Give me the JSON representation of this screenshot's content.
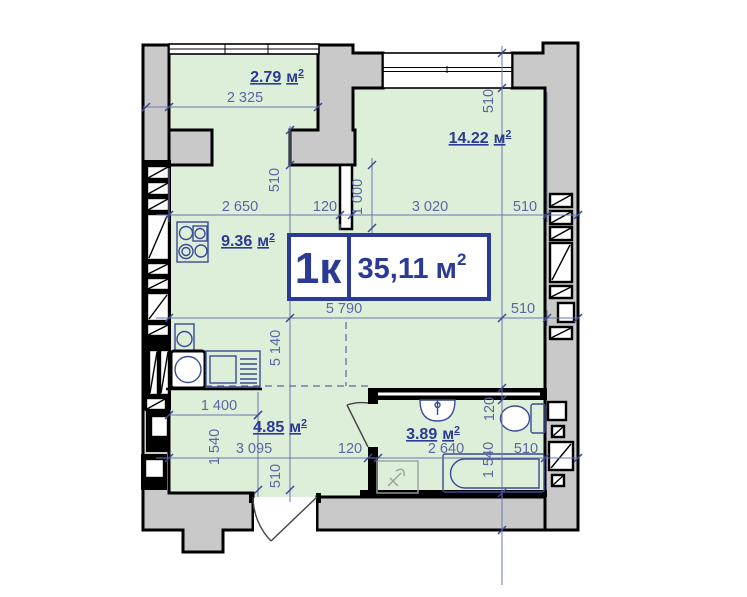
{
  "title_block": {
    "type_label": "1к",
    "area_value": "35,11",
    "unit": "м",
    "sup": "2"
  },
  "rooms": {
    "balcony": {
      "area": "2.79",
      "unit": "м",
      "sup": "2"
    },
    "living": {
      "area": "14.22",
      "unit": "м",
      "sup": "2"
    },
    "kitchen": {
      "area": "9.36",
      "unit": "м",
      "sup": "2"
    },
    "hall": {
      "area": "4.85",
      "unit": "м",
      "sup": "2"
    },
    "bathroom": {
      "area": "3.89",
      "unit": "м",
      "sup": "2"
    }
  },
  "dimensions": {
    "a_balcony_width": "2 325",
    "b_kitchen_width": "2 650",
    "b_partition": "120",
    "b_living_width": "3 020",
    "b_right_wall": "510",
    "v_balcony_wall": "510",
    "v_window_wall": "510",
    "v_partition_len": "1 000",
    "v_living_height": "4 680",
    "c_total_width": "5 790",
    "c_right_wall": "510",
    "v_kitchen_height": "5 140",
    "d_hall_top": "1 400",
    "v_hall_left": "1 540",
    "d_hall_width": "3 095",
    "d_bath_wall": "120",
    "d_bath_width": "2 640",
    "d_right_wall": "510",
    "v_entry_wall": "510",
    "v_bath_wall": "120",
    "v_bath_height": "1 540"
  },
  "colors": {
    "room_fill": "#ddefd8",
    "wall_fill": "#c9c9c9",
    "accent": "#2b3a94",
    "dim_text": "#5b66a4"
  }
}
